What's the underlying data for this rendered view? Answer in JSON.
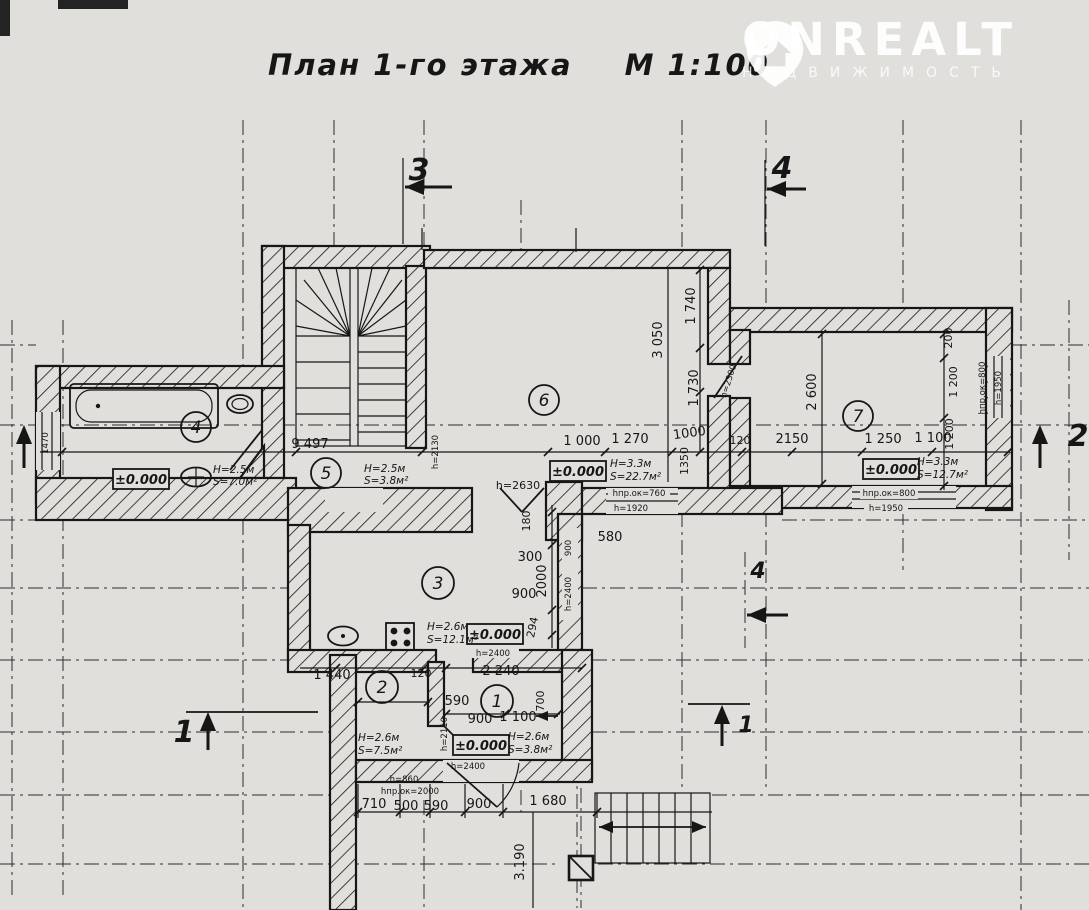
{
  "title": {
    "text": "План 1-го этажа",
    "scale": "М 1:100"
  },
  "watermark": {
    "brand": "ONREALT",
    "tagline": "НЕДВИЖИМОСТЬ"
  },
  "elev": "±0.000",
  "sections": {
    "s1": "1",
    "s2": "2",
    "s3": "3",
    "s4": "4"
  },
  "rooms": [
    {
      "num": "1",
      "h": "H=2.6м",
      "s": "S=3.8м²"
    },
    {
      "num": "2",
      "h": "H=2.6м",
      "s": "S=7.5м²"
    },
    {
      "num": "3",
      "h": "H=2.6м",
      "s": "S=12.1м²"
    },
    {
      "num": "4",
      "h": "H=2.5м",
      "s": "S=7.0м²"
    },
    {
      "num": "5",
      "h": "H=2.5м",
      "s": "S=3.8м²"
    },
    {
      "num": "6",
      "h": "H=3.3м",
      "s": "S=22.7м²"
    },
    {
      "num": "7",
      "h": "H=3.3м",
      "s": "S=12.7м²"
    }
  ],
  "dims": {
    "d9497": "9 497",
    "d1000a": "1 000",
    "d1270": "1 270",
    "d1000b": "1000",
    "d120a": "120",
    "d2150": "2150",
    "d1250": "1 250",
    "d1100a": "1 100",
    "d1350": "1350",
    "d2600": "2 600",
    "d200": "200",
    "d1200a": "1 200",
    "d1200b": "1 200",
    "d3050": "3 050",
    "d1740": "1 740",
    "d1730": "1 730",
    "d180": "180",
    "d580": "580",
    "d300": "300",
    "d2000": "2000",
    "d900a": "900",
    "d294": "294",
    "d900w": "900",
    "d1440": "1 440",
    "d120b": "120",
    "d2240": "2 240",
    "d590a": "590",
    "d900c": "900",
    "d1100b": "1 100",
    "d700": "700",
    "d710": "710",
    "d500": "500",
    "d590b": "590",
    "d900b": "900",
    "d1680": "1 680",
    "d3190": "3.190",
    "d1470": "1470"
  },
  "notes": {
    "h2300": "h=2300",
    "h2630": "h=2630",
    "h2400w": "h=2400",
    "h2400a": "h=2400",
    "h2400b": "h=2400",
    "h2130": "h=2130",
    "h2110": "h=2110",
    "hpo760": "hпр.ок=760",
    "h1920": "h=1920",
    "hpo800a": "hпр.ок=800",
    "h1950a": "h=1950",
    "hpo800b": "hпр.ок=800",
    "h1950b": "h=1950",
    "h860": "h=860",
    "h2000": "hпр.ок=2000"
  }
}
